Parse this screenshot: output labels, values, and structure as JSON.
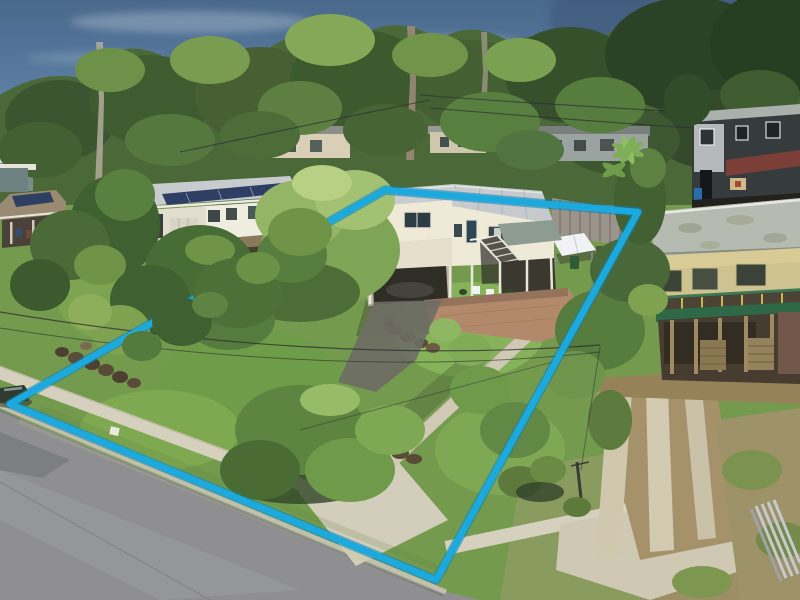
{
  "meta": {
    "image_kind": "aerial real-estate drone photograph",
    "subject": "high-set weatherboard house on a treed suburban lot with a cyan property-boundary outline overlay",
    "visible_text": "none"
  },
  "boundary": {
    "points": "385,190 638,212 436,580 10,404",
    "color": "#1caade",
    "underlay_color": "#0f83b6",
    "stroke_width": "6.5",
    "underlay_width": "9.5"
  },
  "palette": {
    "sky_top": "#49688c",
    "sky_mid": "#5b7fa3",
    "sky_bottom": "#93aec3",
    "canopy_base": "#4b6839",
    "canopy_dark": "#31492a",
    "canopy_light": "#7fa251",
    "lot_lawn": "#749b4d",
    "lawn_bright": "#86b259",
    "street_asphalt": "#8f8f91",
    "kerb_concrete": "#c4beae",
    "path_concrete": "#d0c9b5",
    "footpath_concrete": "#d6d0bf",
    "solar_panel": "#2e3f63",
    "main_roof": "#c6cacd",
    "main_wall": "#efe9d8",
    "brick_paving": "#b28a6b",
    "balcony_green": "#2e6847",
    "stilt_timber": "#a08a62",
    "dirt": "#a5916a"
  },
  "objects": {
    "boundary-line": "cyan lot outline",
    "main-house": "white high-set house with grey metal roof and external staircase",
    "left-neighbor-house": "white house with rooftop solar array",
    "far-left-house": "tan-roof house with solar panels and carport",
    "stilted-neighbor-house": "house on timber stilts with green balcony rail",
    "rear-dark-house": "dark two-storey house with red awning and basketball hoop",
    "marquee-tent": "white gazebo in back yard",
    "street": "asphalt road, bottom left",
    "garden-path": "concrete path from street to house",
    "driveway-strips": "twin concrete wheel strips, right neighbor",
    "parked-car": "dark car at left street edge"
  }
}
